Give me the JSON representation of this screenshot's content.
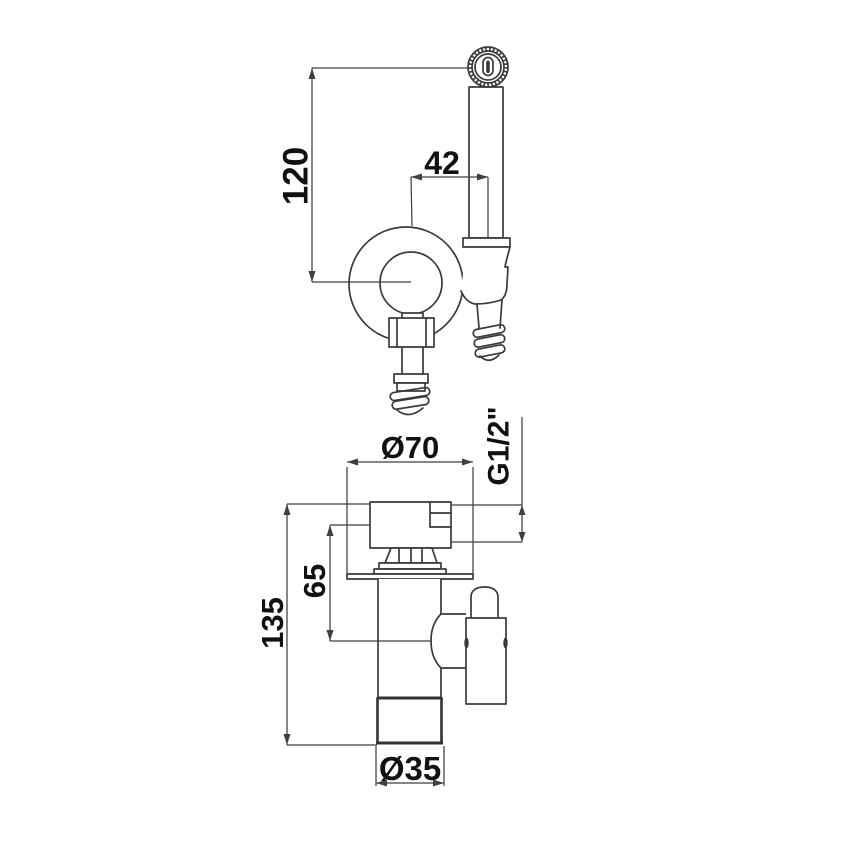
{
  "meta": {
    "background": "#ffffff",
    "line_color": "#3a3a3a",
    "text_color": "#111111",
    "drawing_kind": "dimensioned technical drawing"
  },
  "dimensions": {
    "sprayer_height": {
      "label": "120",
      "orientation": "vertical"
    },
    "sprayer_offset": {
      "label": "42",
      "orientation": "horizontal"
    },
    "plate_diameter": {
      "label": "Ø70",
      "orientation": "horizontal"
    },
    "inlet_thread": {
      "label": "G1/2\"",
      "orientation": "vertical"
    },
    "outlet_height": {
      "label": "65",
      "orientation": "vertical"
    },
    "valve_height": {
      "label": "135",
      "orientation": "vertical"
    },
    "valve_diameter": {
      "label": "Ø35",
      "orientation": "horizontal"
    }
  }
}
